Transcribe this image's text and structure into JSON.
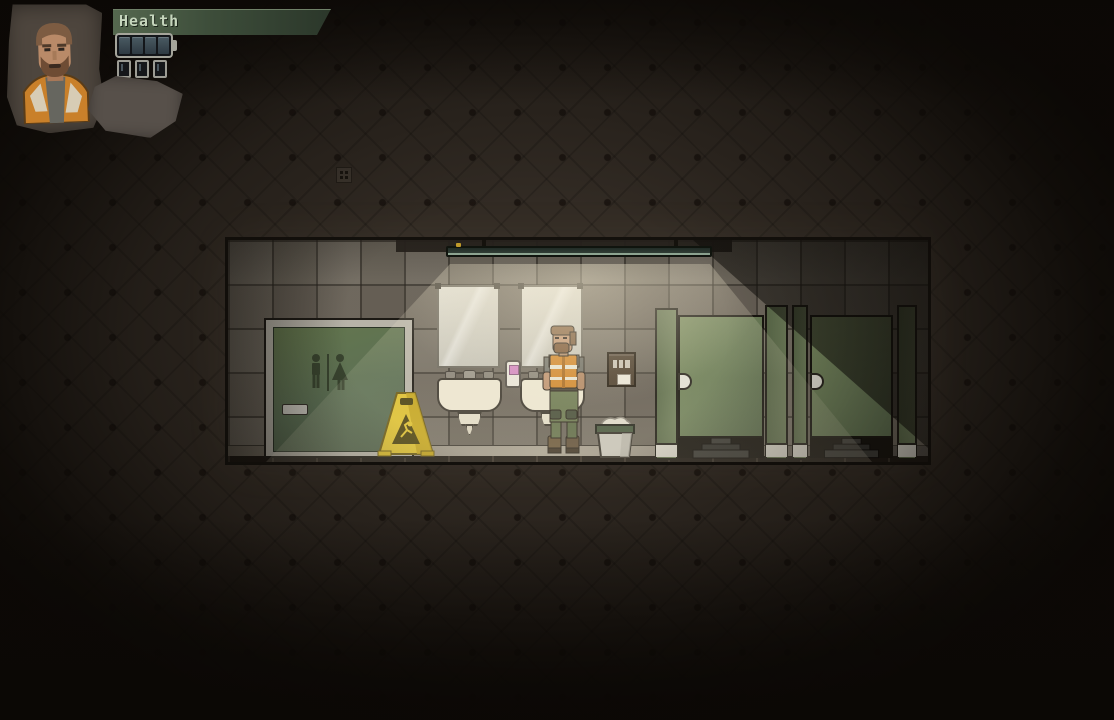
{
  "hud": {
    "health": {
      "label": "Health",
      "segments_filled": 4,
      "segments_total": 4
    },
    "mini_slot_count": 3,
    "portrait": "bearded survivor in orange safety vest on torn paper"
  },
  "scene": {
    "room_type": "public restroom interior, side view",
    "objects": {
      "restroom_door": "green door with men/women pictogram sign and metal handle",
      "wet_floor_sign": "yellow A-frame caution sign with slip warning",
      "mirror_1": "wall mirror above first sink",
      "mirror_2": "wall mirror above second sink",
      "sink_1": "cream ceramic wash basin with faucet",
      "sink_2": "cream ceramic wash basin behind player",
      "soap_dispenser": "white dispenser with pink window",
      "towel_dispenser": "dark brown paper towel dispenser with paper",
      "trash_can": "gray bin with green rim and crumpled paper",
      "stall_1": "toilet stall with green door, latch and toilet base",
      "stall_2": "toilet stall with green door, latch and toilet base",
      "ceiling_light": "long fluorescent tube fixture casting light cone",
      "player_character": "man with beard, gray shirt, orange hi-vis vest, green cargo pants, boots",
      "wall_vent": "small vent square in dark background wall"
    }
  },
  "colors": {
    "background_brown": "#322b24",
    "wall_tile_lit": "#a8a192",
    "wall_tile_dark": "#57514a",
    "door_green": "#5d7055",
    "stall_green": "#6a7b57",
    "caution_yellow": "#dcbf31",
    "vest_orange": "#d0862c",
    "sink_cream": "#ece6d2",
    "hud_bar_green": "#3d4d3a",
    "hud_text_green": "#c6d6bd",
    "battery_segment": "#3c4a52"
  }
}
